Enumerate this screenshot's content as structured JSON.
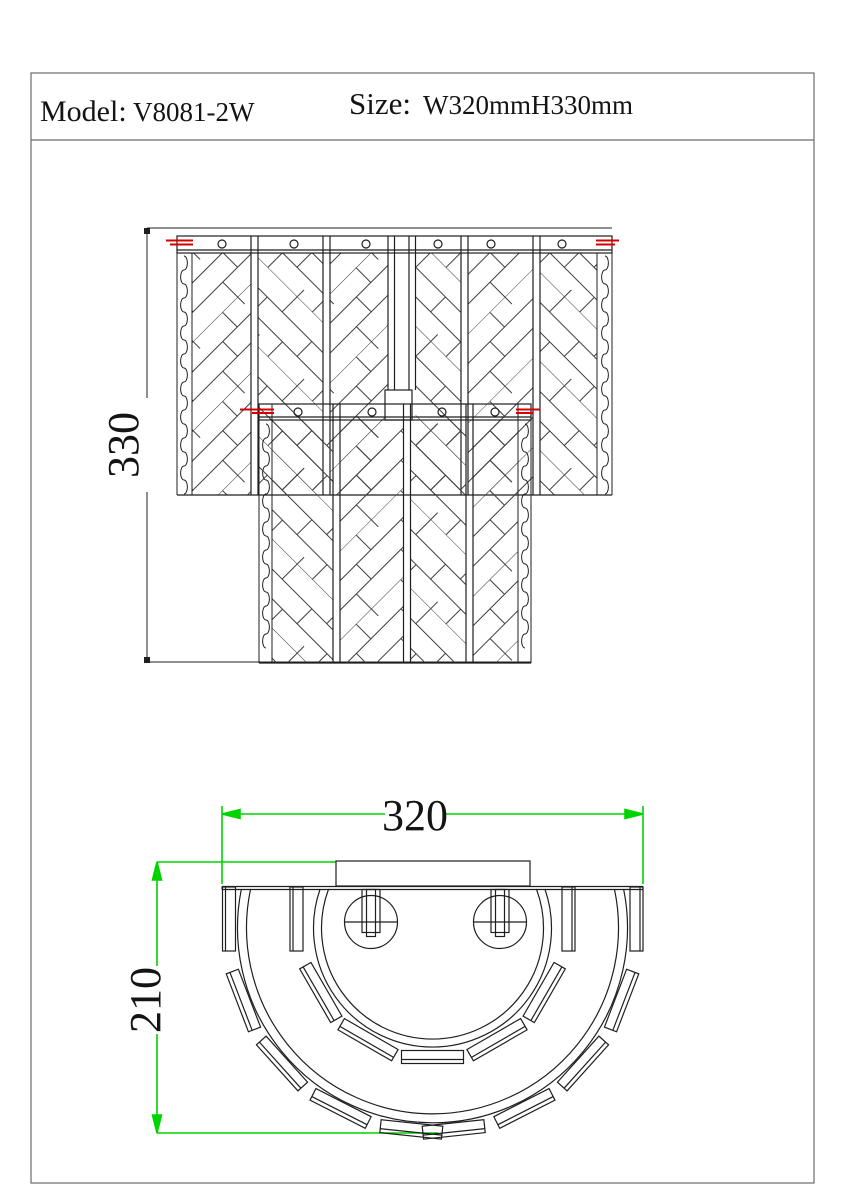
{
  "title_block": {
    "model_label": "Model:",
    "model_value": "V8081-2W",
    "size_label": "Size:",
    "size_value": "W320mmH330mm"
  },
  "front_view": {
    "view_name": "front-elevation",
    "height_dim_value": "330"
  },
  "plan_view": {
    "view_name": "bottom-plan",
    "width_dim_value": "320",
    "depth_dim_value": "210"
  },
  "colors": {
    "dimension_green": "#00d400",
    "centerline_red": "#d40000",
    "line_black": "#1f1f1f"
  }
}
